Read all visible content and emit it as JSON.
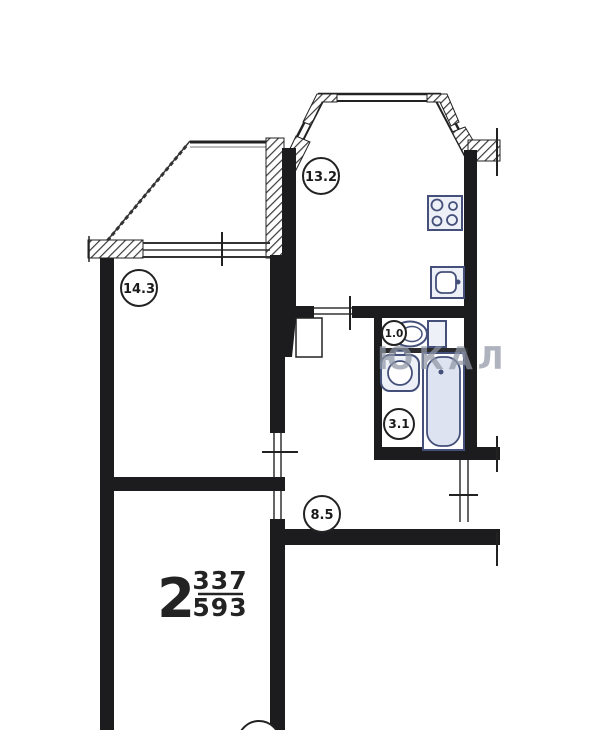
{
  "plan": {
    "apartment_type": {
      "rooms": "2",
      "area_numerator": "337",
      "area_denominator": "593"
    },
    "room_labels": [
      {
        "room": "kitchen",
        "value": "13.2"
      },
      {
        "room": "living-room",
        "value": "14.3"
      },
      {
        "room": "toilet",
        "value": "1.0"
      },
      {
        "room": "bathroom",
        "value": "3.1"
      },
      {
        "room": "hallway",
        "value": "8.5"
      }
    ],
    "fixtures": [
      "stove-icon",
      "kitchen-sink-icon",
      "toilet-icon",
      "washbasin-icon",
      "bathtub-icon"
    ],
    "watermark": "ЮКАЛ",
    "colors": {
      "wall": "#1c1c1e",
      "line": "#333333",
      "fixture_stroke": "#44507a",
      "fixture_fill": "#edf0f7",
      "tub_fill": "#dde3f0",
      "watermark": "#8f97a6"
    }
  }
}
